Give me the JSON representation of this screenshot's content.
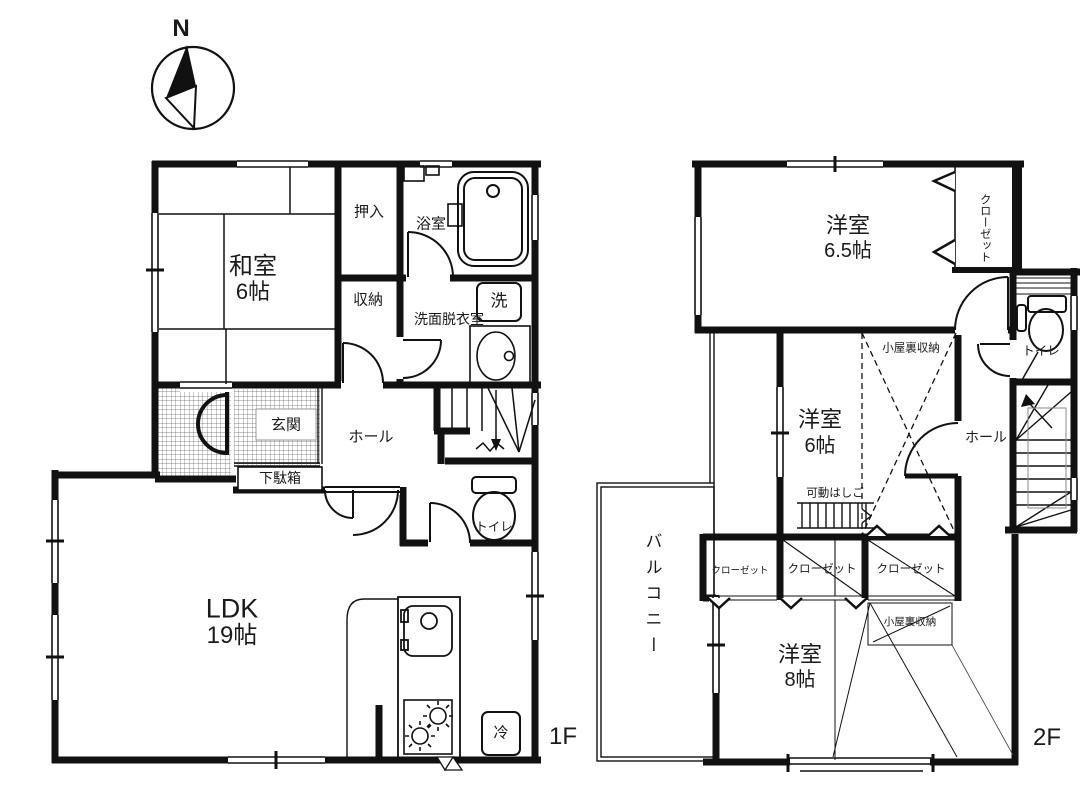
{
  "compass": {
    "north_label": "N"
  },
  "floor1": {
    "floor_label": "1F",
    "rooms": {
      "washitsu": {
        "name": "和室",
        "size": "6帖"
      },
      "oshiire": "押入",
      "bathroom": "浴室",
      "storage": "収納",
      "washroom": "洗面脱衣室",
      "washer": "洗",
      "genkan": "玄関",
      "getabako": "下駄箱",
      "hall": "ホール",
      "toilet": "トイレ",
      "ldk": {
        "name": "LDK",
        "size": "19帖"
      },
      "fridge": "冷"
    }
  },
  "floor2": {
    "floor_label": "2F",
    "rooms": {
      "bedroom65": {
        "name": "洋室",
        "size": "6.5帖"
      },
      "closet_upper": "クローゼット",
      "toilet": "トイレ",
      "hall": "ホール",
      "bedroom6": {
        "name": "洋室",
        "size": "6帖"
      },
      "attic6": "小屋裏収納",
      "ladder": "可動はしご",
      "closet1": "クローゼット",
      "closet2": "クローゼット",
      "closet3": "クローゼット",
      "balcony": "バルコニー",
      "bedroom8": {
        "name": "洋室",
        "size": "8帖"
      },
      "attic8": "小屋裏収納"
    }
  }
}
